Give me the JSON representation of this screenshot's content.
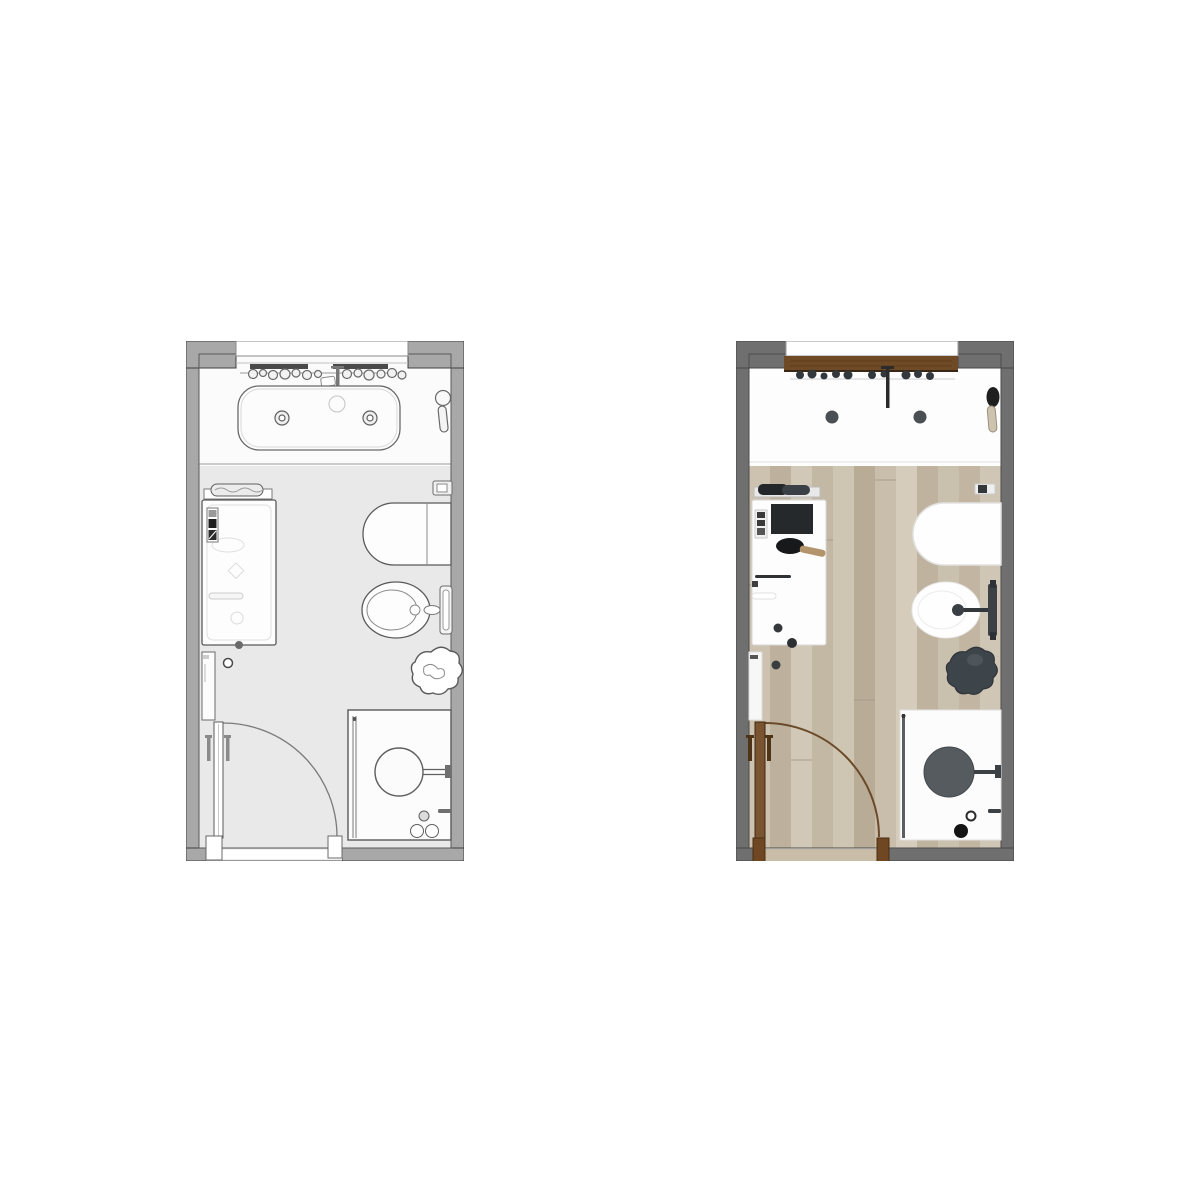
{
  "scene": {
    "type": "bathroom-floor-plan-comparison",
    "background": "#ffffff"
  },
  "plans": {
    "schematic": {
      "position": "left",
      "style": "line-drawing floor plan",
      "colors": {
        "wall": "#a8a8a8",
        "wall_stroke": "#3f3f3f",
        "floor": "#e9e9e9",
        "vanity_area": "#fbfbfb",
        "fixture_fill": "#fdfdfd",
        "fixture_stroke": "#5a5a5a",
        "detail_dark": "#2a2a2a",
        "shelf_bar": "#4a4a4a"
      },
      "fixtures": [
        "wall-shelf-with-toiletries",
        "wall-faucet",
        "double-trough-sink",
        "hand-mirror",
        "towel-rail",
        "bathtub",
        "bath-control-panel",
        "wall-cabinet",
        "entry-door-with-swing-arc",
        "wall-hung-toilet",
        "flush-plate",
        "bidet",
        "potted-plant",
        "walk-in-shower",
        "rain-shower-head",
        "shower-glass-panel"
      ]
    },
    "rendered": {
      "position": "right",
      "style": "textured rendered floor plan",
      "colors": {
        "wall": "#6f6f6f",
        "wall_stroke": "#474747",
        "wood_floor_base": "#c7bcaa",
        "wood_shelf": "#6f4a26",
        "door_wood": "#7a5331",
        "door_arc": "#6b4a2a",
        "door_post": "#6f4722",
        "threshold_wood": "#c9bda7",
        "fixture_white": "#fdfdfd",
        "fixture_dark": "#3c4145",
        "shower_head": "#565b60",
        "plant": "#3e454a",
        "towel_dark": "#23272a",
        "brush_wood": "#b3946b"
      },
      "floor_planks": [
        "#cdc2b0",
        "#bdb19d",
        "#d2c8b8",
        "#c3b8a4",
        "#cfc5b3",
        "#b8ac97",
        "#c9beab",
        "#d5ccbc",
        "#bfb3a0",
        "#cac0ae",
        "#c2b6a2",
        "#d0c6b5"
      ],
      "fixtures": [
        "wood-shelf-with-toiletries",
        "dark-wall-faucet",
        "white-vanity-with-two-drains",
        "hairdryer",
        "towel-rail-with-dark-towels",
        "bathtub-with-headrest",
        "bath-control-panel",
        "grab-bar",
        "wall-cabinet",
        "wood-entry-door-with-swing-arc",
        "wall-hung-toilet",
        "flush-plate",
        "bidet-with-dark-faucet",
        "dark-potted-plant",
        "walk-in-shower",
        "dark-rain-shower-head",
        "shower-glass-panel"
      ]
    }
  }
}
